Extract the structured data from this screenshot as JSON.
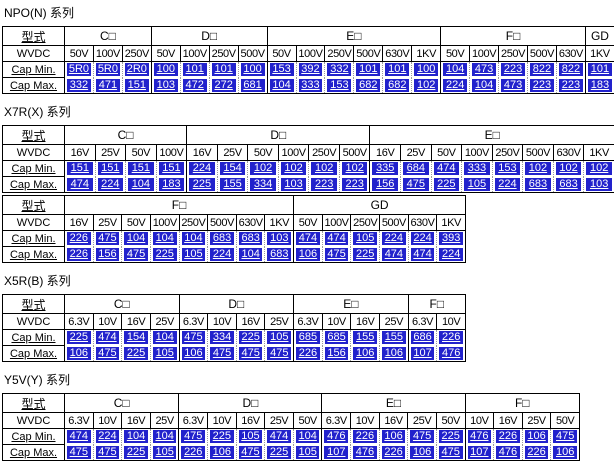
{
  "colors": {
    "value_cell_bg": "#2222CC",
    "value_cell_text": "#ffffff",
    "table_border": "#000000",
    "page_bg": "#ffffff"
  },
  "labels": {
    "type": "型式",
    "wvdc": "WVDC",
    "cap_min": "Cap Min.",
    "cap_max": "Cap Max."
  },
  "sections": [
    {
      "title": "NPO(N) 系列",
      "tables": [
        {
          "groups": [
            {
              "name": "C□",
              "voltages": [
                "50V",
                "100V",
                "250V"
              ],
              "min": [
                "5R0",
                "5R0",
                "2R0"
              ],
              "max": [
                "332",
                "471",
                "151"
              ]
            },
            {
              "name": "D□",
              "voltages": [
                "50V",
                "100V",
                "250V",
                "500V"
              ],
              "min": [
                "100",
                "101",
                "101",
                "100"
              ],
              "max": [
                "103",
                "472",
                "272",
                "681"
              ]
            },
            {
              "name": "E□",
              "voltages": [
                "50V",
                "100V",
                "250V",
                "500V",
                "630V",
                "1KV"
              ],
              "min": [
                "153",
                "392",
                "332",
                "101",
                "101",
                "100"
              ],
              "max": [
                "104",
                "333",
                "153",
                "682",
                "682",
                "102"
              ]
            },
            {
              "name": "F□",
              "voltages": [
                "50V",
                "100V",
                "250V",
                "500V",
                "630V"
              ],
              "min": [
                "104",
                "473",
                "223",
                "822",
                "822"
              ],
              "max": [
                "224",
                "104",
                "473",
                "223",
                "223"
              ]
            },
            {
              "name": "GD",
              "voltages": [
                "1KV"
              ],
              "min": [
                "101"
              ],
              "max": [
                "183"
              ]
            }
          ]
        }
      ]
    },
    {
      "title": "X7R(X) 系列",
      "tables": [
        {
          "groups": [
            {
              "name": "C□",
              "voltages": [
                "16V",
                "25V",
                "50V",
                "100V"
              ],
              "min": [
                "151",
                "151",
                "151",
                "151"
              ],
              "max": [
                "474",
                "224",
                "104",
                "183"
              ]
            },
            {
              "name": "D□",
              "voltages": [
                "16V",
                "25V",
                "50V",
                "100V",
                "250V",
                "500V"
              ],
              "min": [
                "224",
                "154",
                "102",
                "102",
                "102",
                "102"
              ],
              "max": [
                "225",
                "155",
                "334",
                "103",
                "223",
                "223"
              ]
            },
            {
              "name": "E□",
              "voltages": [
                "16V",
                "25V",
                "50V",
                "100V",
                "250V",
                "500V",
                "630V",
                "1KV"
              ],
              "min": [
                "335",
                "684",
                "474",
                "333",
                "153",
                "102",
                "102",
                "102"
              ],
              "max": [
                "156",
                "475",
                "225",
                "105",
                "224",
                "683",
                "683",
                "103"
              ]
            }
          ]
        },
        {
          "groups": [
            {
              "name": "F□",
              "voltages": [
                "16V",
                "25V",
                "50V",
                "100V",
                "250V",
                "500V",
                "630V",
                "1KV"
              ],
              "min": [
                "226",
                "475",
                "104",
                "104",
                "104",
                "683",
                "683",
                "103"
              ],
              "max": [
                "226",
                "156",
                "475",
                "225",
                "105",
                "224",
                "104",
                "683"
              ]
            },
            {
              "name": "GD",
              "voltages": [
                "50V",
                "100V",
                "250V",
                "500V",
                "630V",
                "1KV"
              ],
              "min": [
                "474",
                "474",
                "105",
                "224",
                "224",
                "393"
              ],
              "max": [
                "106",
                "475",
                "225",
                "474",
                "474",
                "224"
              ]
            }
          ]
        }
      ]
    },
    {
      "title": "X5R(B) 系列",
      "tables": [
        {
          "groups": [
            {
              "name": "C□",
              "voltages": [
                "6.3V",
                "10V",
                "16V",
                "25V"
              ],
              "min": [
                "225",
                "474",
                "154",
                "104"
              ],
              "max": [
                "106",
                "475",
                "225",
                "105"
              ]
            },
            {
              "name": "D□",
              "voltages": [
                "6.3V",
                "10V",
                "16V",
                "25V"
              ],
              "min": [
                "475",
                "334",
                "225",
                "105"
              ],
              "max": [
                "106",
                "475",
                "475",
                "475"
              ]
            },
            {
              "name": "E□",
              "voltages": [
                "6.3V",
                "10V",
                "16V",
                "25V"
              ],
              "min": [
                "685",
                "685",
                "155",
                "155"
              ],
              "max": [
                "226",
                "156",
                "106",
                "106"
              ]
            },
            {
              "name": "F□",
              "voltages": [
                "6.3V",
                "10V"
              ],
              "min": [
                "686",
                "226"
              ],
              "max": [
                "107",
                "476"
              ]
            }
          ]
        }
      ]
    },
    {
      "title": "Y5V(Y) 系列",
      "tables": [
        {
          "groups": [
            {
              "name": "C□",
              "voltages": [
                "6.3V",
                "10V",
                "16V",
                "25V"
              ],
              "min": [
                "474",
                "224",
                "104",
                "104"
              ],
              "max": [
                "475",
                "475",
                "225",
                "105"
              ]
            },
            {
              "name": "D□",
              "voltages": [
                "6.3V",
                "10V",
                "16V",
                "25V",
                "50V"
              ],
              "min": [
                "475",
                "225",
                "105",
                "474",
                "104"
              ],
              "max": [
                "226",
                "106",
                "475",
                "225",
                "105"
              ]
            },
            {
              "name": "E□",
              "voltages": [
                "6.3V",
                "10V",
                "16V",
                "25V",
                "50V"
              ],
              "min": [
                "476",
                "226",
                "106",
                "475",
                "225"
              ],
              "max": [
                "107",
                "476",
                "226",
                "106",
                "475"
              ]
            },
            {
              "name": "F□",
              "voltages": [
                "10V",
                "16V",
                "25V",
                "50V"
              ],
              "min": [
                "476",
                "226",
                "106",
                "475"
              ],
              "max": [
                "107",
                "476",
                "226",
                "106"
              ]
            }
          ]
        }
      ]
    }
  ]
}
